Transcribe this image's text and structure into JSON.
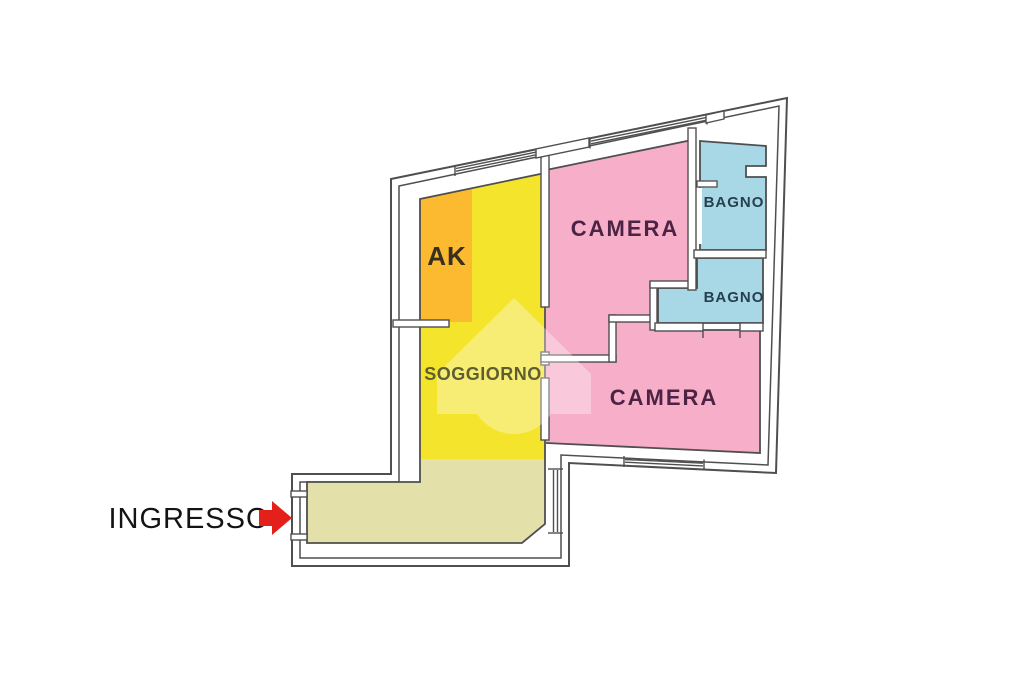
{
  "plan": {
    "rooms": {
      "ak": {
        "label": "AK",
        "color": "#FBBA30",
        "label_color": "#38301f"
      },
      "soggiorno": {
        "label": "SOGGIORNO",
        "color": "#F5E42C",
        "label_color": "#5e5e30"
      },
      "ingresso_area": {
        "color": "#E3E0A9"
      },
      "camera_1": {
        "label": "CAMERA",
        "color": "#F6AEC9",
        "label_color": "#4d2344"
      },
      "camera_2": {
        "label": "CAMERA",
        "color": "#F6AEC9",
        "label_color": "#4d2344"
      },
      "bagno_1": {
        "label": "BAGNO",
        "color": "#A8D7E5",
        "label_color": "#27404f"
      },
      "bagno_2": {
        "label": "BAGNO",
        "color": "#A8D7E5",
        "label_color": "#27404f"
      }
    },
    "entrance": {
      "label": "INGRESSO",
      "label_color": "#141414",
      "arrow_color": "#E3211A"
    },
    "wall_color": "#4f4f4f",
    "background": "#ffffff",
    "watermark": {
      "icon": "house-logo",
      "color": "#ffffff"
    }
  }
}
